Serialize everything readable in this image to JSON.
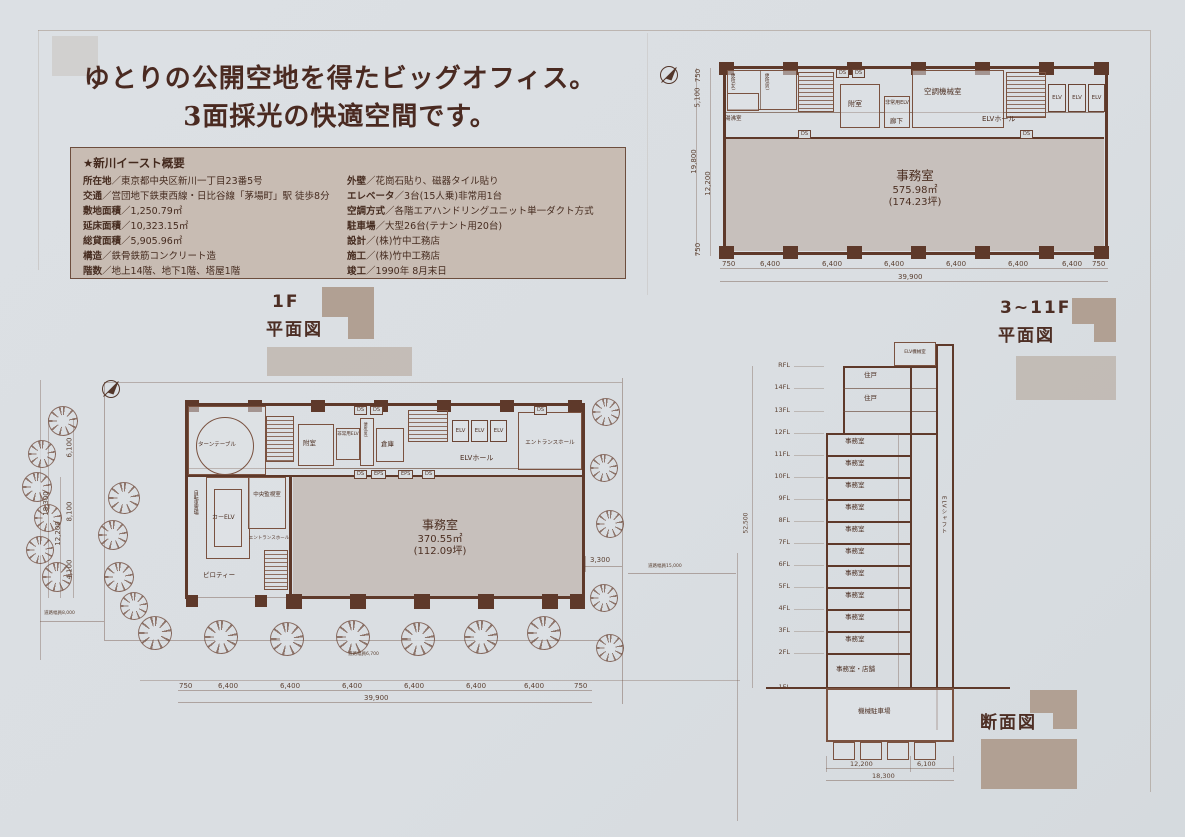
{
  "colors": {
    "paper": "#dce0e4",
    "ink": "#4f3326",
    "wall": "#5e392a",
    "office_fill": "#c7c0bc",
    "deco_block": "#b1a093",
    "overview_bg": "#c8bcb3",
    "headline": "#4a2a21"
  },
  "headline": {
    "line1": "ゆとりの公開空地を得たビッグオフィス。",
    "line2": "3面採光の快適空間です。"
  },
  "overview": {
    "title": "★新川イースト概要",
    "separator": "／",
    "left": [
      {
        "label": "所在地",
        "value": "東京都中央区新川一丁目23番5号"
      },
      {
        "label": "交通",
        "value": "営団地下鉄東西線・日比谷線「茅場町」駅 徒歩8分"
      },
      {
        "label": "敷地面積",
        "value": "1,250.79㎡"
      },
      {
        "label": "延床面積",
        "value": "10,323.15㎡"
      },
      {
        "label": "総貸面積",
        "value": "5,905.96㎡"
      },
      {
        "label": "構造",
        "value": "鉄骨鉄筋コンクリート造"
      },
      {
        "label": "階数",
        "value": "地上14階、地下1階、塔屋1階"
      }
    ],
    "right": [
      {
        "label": "外壁",
        "value": "花崗石貼り、磁器タイル貼り"
      },
      {
        "label": "エレベータ",
        "value": "3台(15人乗)非常用1台"
      },
      {
        "label": "空調方式",
        "value": "各階エアハンドリングユニット単一ダクト方式"
      },
      {
        "label": "駐車場",
        "value": "大型26台(テナント用20台)"
      },
      {
        "label": "設計",
        "value": "(株)竹中工務店"
      },
      {
        "label": "施工",
        "value": "(株)竹中工務店"
      },
      {
        "label": "竣工",
        "value": "1990年 8月末日"
      }
    ]
  },
  "captions": {
    "plan1f_line1": "1F",
    "plan1f_line2": "平面図",
    "plan311_line1": "3~11F",
    "plan311_line2": "平面図",
    "section": "断面図"
  },
  "labels": {
    "ds": "DS",
    "eps": "EPS",
    "elv": "ELV",
    "elv_hall": "ELVホール",
    "corridor": "廊下",
    "fushitsu": "附室",
    "emergency_elv": "非常用ELV",
    "kucho": "空調機械室",
    "yuwakashi": "湯沸室",
    "wc_w": "便所(女)",
    "wc_m": "便所(男)",
    "souko": "倉庫",
    "office": "事務室",
    "entrance_hall": "エントランスホール",
    "turntable": "ターンテーブル",
    "car_elv": "カーELV",
    "chuo_kanshi": "中央監視室",
    "jitensha": "自転車置場",
    "piloti": "ピロティー",
    "juko": "住戸",
    "office_shop": "事務室・店舗",
    "kikai_parking": "機械駐車場",
    "elv_shaft": "ELVシャフト",
    "elv_kikai": "ELV機械室"
  },
  "plan_upper": {
    "office_area": "575.98㎡",
    "office_tsubo": "(174.23坪)",
    "dims": {
      "d750": "750",
      "d5100": "5,100",
      "d19800": "19,800",
      "d12200": "12,200",
      "d6400": "6,400",
      "d39900": "39,900"
    }
  },
  "plan_1f": {
    "office_area": "370.55㎡",
    "office_tsubo": "(112.09坪)",
    "dims": {
      "d18300": "18,300",
      "d12200": "12,200",
      "d6100": "6,100",
      "d8100": "8,100",
      "d4100": "4,100",
      "d3300": "3,300",
      "d750": "750",
      "d6400": "6,400",
      "d39900": "39,900"
    },
    "roads": {
      "left": "道路幅員8,000",
      "bottom": "道路幅員6,700",
      "right": "道路幅員15,000"
    }
  },
  "section": {
    "floors": [
      "RFL",
      "14FL",
      "13FL",
      "12FL",
      "11FL",
      "10FL",
      "9FL",
      "8FL",
      "7FL",
      "6FL",
      "5FL",
      "4FL",
      "3FL",
      "2FL",
      "1FL"
    ],
    "dims": {
      "d12200": "12,200",
      "d6100": "6,100",
      "d18300": "18,300",
      "total": "52,500"
    }
  }
}
